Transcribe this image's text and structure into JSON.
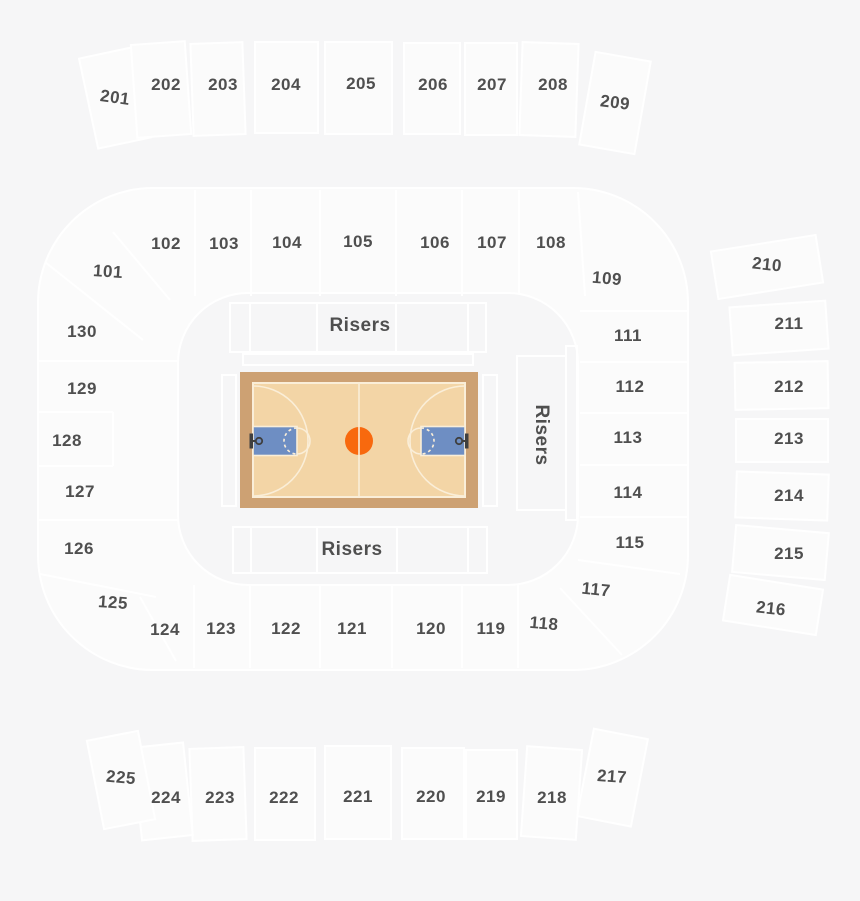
{
  "chart_title": "Arena seating chart with basketball court",
  "colors": {
    "bg": "#f6f6f7",
    "section_fill": "#fbfbfb",
    "line": "#ffffff",
    "label": "#4f4f4f",
    "court_border": "#cda173",
    "court_floor": "#f3d5a6",
    "court_line": "#faeed8",
    "key": "#6e8ec3",
    "center_circle": "#f8690e",
    "hoop": "#3f3f3f"
  },
  "labels": {
    "risers_top": "Risers",
    "risers_bottom": "Risers",
    "risers_right": "Risers"
  },
  "sections": [
    {
      "label": "101",
      "x": 108,
      "y": 272,
      "rotate": 4
    },
    {
      "label": "102",
      "x": 166,
      "y": 244
    },
    {
      "label": "103",
      "x": 224,
      "y": 244
    },
    {
      "label": "104",
      "x": 287,
      "y": 243
    },
    {
      "label": "105",
      "x": 358,
      "y": 242
    },
    {
      "label": "106",
      "x": 435,
      "y": 243
    },
    {
      "label": "107",
      "x": 492,
      "y": 243
    },
    {
      "label": "108",
      "x": 551,
      "y": 243
    },
    {
      "label": "109",
      "x": 607,
      "y": 279,
      "rotate": 5
    },
    {
      "label": "111",
      "x": 628,
      "y": 336
    },
    {
      "label": "112",
      "x": 630,
      "y": 387
    },
    {
      "label": "113",
      "x": 628,
      "y": 438
    },
    {
      "label": "114",
      "x": 628,
      "y": 493
    },
    {
      "label": "115",
      "x": 630,
      "y": 543
    },
    {
      "label": "117",
      "x": 596,
      "y": 590,
      "rotate": 6
    },
    {
      "label": "118",
      "x": 544,
      "y": 624,
      "rotate": 5
    },
    {
      "label": "119",
      "x": 491,
      "y": 629
    },
    {
      "label": "120",
      "x": 431,
      "y": 629
    },
    {
      "label": "121",
      "x": 352,
      "y": 629
    },
    {
      "label": "122",
      "x": 286,
      "y": 629
    },
    {
      "label": "123",
      "x": 221,
      "y": 629
    },
    {
      "label": "124",
      "x": 165,
      "y": 630
    },
    {
      "label": "125",
      "x": 113,
      "y": 603,
      "rotate": 4
    },
    {
      "label": "126",
      "x": 79,
      "y": 549
    },
    {
      "label": "127",
      "x": 80,
      "y": 492
    },
    {
      "label": "128",
      "x": 67,
      "y": 441
    },
    {
      "label": "129",
      "x": 82,
      "y": 389
    },
    {
      "label": "130",
      "x": 82,
      "y": 332
    },
    {
      "label": "201",
      "x": 115,
      "y": 98,
      "rotate": 8
    },
    {
      "label": "202",
      "x": 166,
      "y": 85
    },
    {
      "label": "203",
      "x": 223,
      "y": 85
    },
    {
      "label": "204",
      "x": 286,
      "y": 85
    },
    {
      "label": "205",
      "x": 361,
      "y": 84
    },
    {
      "label": "206",
      "x": 433,
      "y": 85
    },
    {
      "label": "207",
      "x": 492,
      "y": 85
    },
    {
      "label": "208",
      "x": 553,
      "y": 85
    },
    {
      "label": "209",
      "x": 615,
      "y": 103,
      "rotate": 7
    },
    {
      "label": "210",
      "x": 767,
      "y": 265,
      "rotate": 6
    },
    {
      "label": "211",
      "x": 789,
      "y": 324
    },
    {
      "label": "212",
      "x": 789,
      "y": 387
    },
    {
      "label": "213",
      "x": 789,
      "y": 439
    },
    {
      "label": "214",
      "x": 789,
      "y": 496
    },
    {
      "label": "215",
      "x": 789,
      "y": 554
    },
    {
      "label": "216",
      "x": 771,
      "y": 609,
      "rotate": 6
    },
    {
      "label": "217",
      "x": 612,
      "y": 777,
      "rotate": 4
    },
    {
      "label": "218",
      "x": 552,
      "y": 798
    },
    {
      "label": "219",
      "x": 491,
      "y": 797
    },
    {
      "label": "220",
      "x": 431,
      "y": 797
    },
    {
      "label": "221",
      "x": 358,
      "y": 797
    },
    {
      "label": "222",
      "x": 284,
      "y": 798
    },
    {
      "label": "223",
      "x": 220,
      "y": 798
    },
    {
      "label": "224",
      "x": 166,
      "y": 798
    },
    {
      "label": "225",
      "x": 121,
      "y": 778,
      "rotate": 5
    }
  ]
}
